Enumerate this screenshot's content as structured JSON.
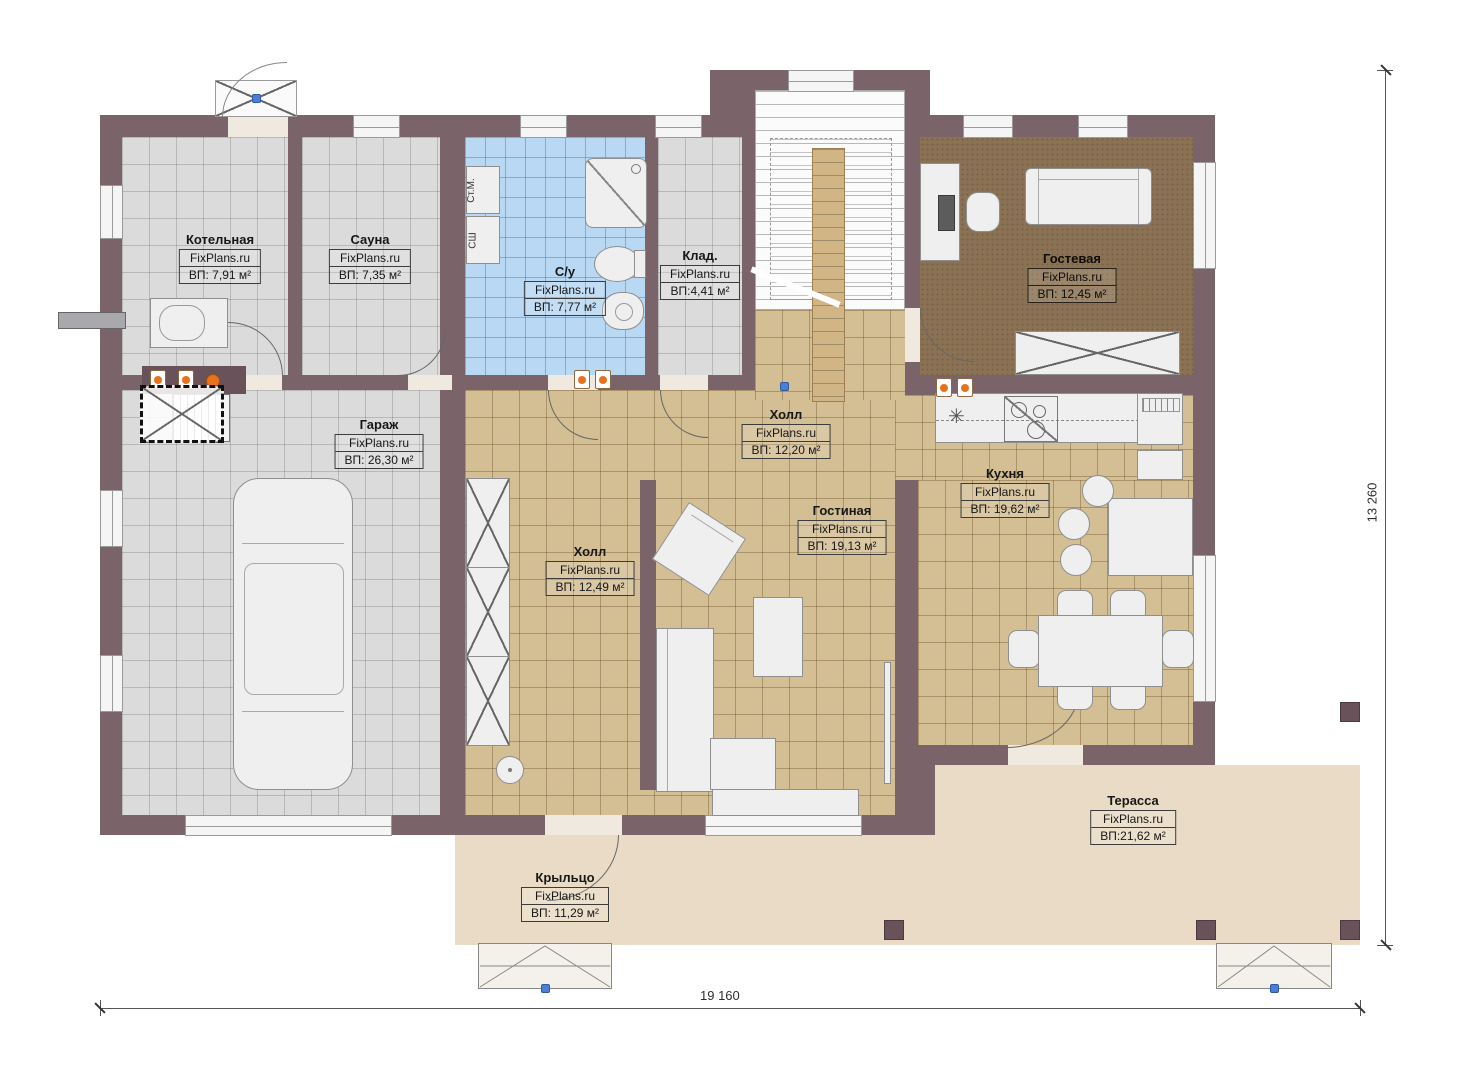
{
  "watermark": "FixPlans.ru",
  "dimensions": {
    "bottom": "19 160",
    "right": "13 260"
  },
  "fixtures": {
    "washing_machine": "Ст.М.",
    "drying_cabinet": "СШ"
  },
  "rooms": [
    {
      "name": "Котельная",
      "brand": "FixPlans.ru",
      "area": "ВП: 7,91 м²"
    },
    {
      "name": "Сауна",
      "brand": "FixPlans.ru",
      "area": "ВП: 7,35 м²"
    },
    {
      "name": "С/у",
      "brand": "FixPlans.ru",
      "area": "ВП: 7,77 м²"
    },
    {
      "name": "Клад.",
      "brand": "FixPlans.ru",
      "area": "ВП:4,41 м²"
    },
    {
      "name": "Гостевая",
      "brand": "FixPlans.ru",
      "area": "ВП: 12,45 м²"
    },
    {
      "name": "Гараж",
      "brand": "FixPlans.ru",
      "area": "ВП: 26,30 м²"
    },
    {
      "name": "Холл",
      "brand": "FixPlans.ru",
      "area": "ВП: 12,20 м²"
    },
    {
      "name": "Холл",
      "brand": "FixPlans.ru",
      "area": "ВП: 12,49 м²"
    },
    {
      "name": "Гостиная",
      "brand": "FixPlans.ru",
      "area": "ВП: 19,13 м²"
    },
    {
      "name": "Кухня",
      "brand": "FixPlans.ru",
      "area": "ВП: 19,62 м²"
    },
    {
      "name": "Терасса",
      "brand": "FixPlans.ru",
      "area": "ВП:21,62 м²"
    },
    {
      "name": "Крыльцо",
      "brand": "FixPlans.ru",
      "area": "ВП: 11,29 м²"
    }
  ],
  "colors": {
    "wall": "#7a646a",
    "floor_gray": "#dbdbdb",
    "floor_tan": "#d4be93",
    "floor_blue": "#b9d8f4",
    "floor_guest": "#8b7254",
    "terrace": "#e9dbc5",
    "accent_orange": "#e8721c",
    "furniture": "#efefef"
  }
}
